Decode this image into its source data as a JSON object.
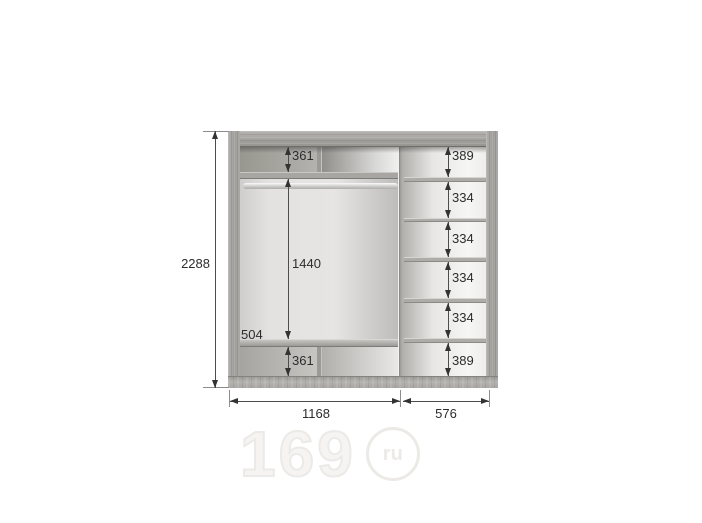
{
  "diagram_title": "wardrobe-interior-dimensions",
  "dims": {
    "overall_height": "2288",
    "bottom_width_left": "1168",
    "bottom_width_right": "576",
    "left_section": {
      "top_compartment": "361",
      "hanging_area": "1440",
      "shelf_depth": "504",
      "bottom_compartment": "361"
    },
    "right_compartments": [
      "389",
      "334",
      "334",
      "334",
      "334",
      "389"
    ]
  },
  "watermark": {
    "number": "169",
    "tld": "ru"
  },
  "colors": {
    "frame_gray": "#a5a3a0",
    "interior_light": "#e6e5e3",
    "dimension_ink": "#333333",
    "watermark_gray": "#eceae7",
    "background": "#ffffff"
  }
}
